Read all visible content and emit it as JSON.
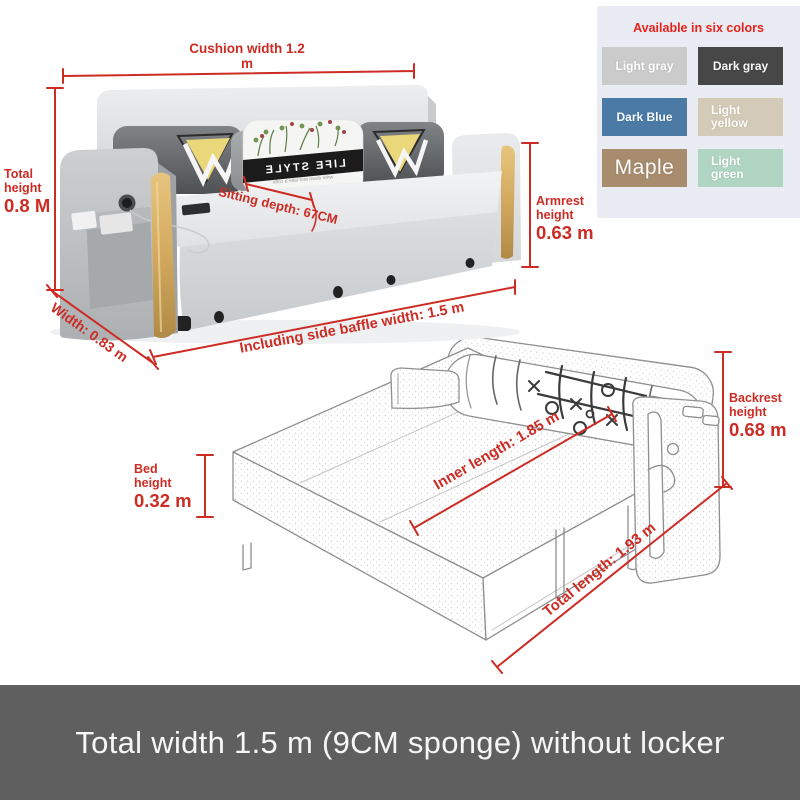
{
  "theme": {
    "accent_red": "#cd2c24",
    "panel_bg": "#e9edf3",
    "footer_bg": "#5f5f5f",
    "wood": "#c9a05c"
  },
  "colors_panel": {
    "title": "Available in six colors",
    "swatches": [
      {
        "label": "Light gray",
        "hex": "#cbcbcb"
      },
      {
        "label": "Dark gray",
        "hex": "#474747"
      },
      {
        "label": "Dark Blue",
        "hex": "#4b7aa7"
      },
      {
        "label": "Light yellow",
        "hex": "#d3cbb7"
      },
      {
        "label": "Maple",
        "hex": "#a78c6d"
      },
      {
        "label": "Light green",
        "hex": "#b1d5c3"
      }
    ]
  },
  "pillow": {
    "brand_text": "LIFE STYLE",
    "sub_text": "write down and take a coffe"
  },
  "dimensions": {
    "cushion_width": "Cushion width 1.2 m",
    "total_height": {
      "line1": "Total",
      "line2": "height",
      "value": "0.8 M"
    },
    "width": "Width: 0.83 m",
    "sitting_depth": "Sitting depth: 67CM",
    "armrest_height": {
      "line1": "Armrest",
      "line2": "height",
      "value": "0.63 m"
    },
    "baffle_width": "Including side baffle width: 1.5 m",
    "bed_height": {
      "line1": "Bed",
      "line2": "height",
      "value": "0.32 m"
    },
    "inner_length": "Inner length: 1.85 m",
    "backrest_height": {
      "line1": "Backrest",
      "line2": "height",
      "value": "0.68 m"
    },
    "total_length": "Total length: 1.93 m"
  },
  "footer": {
    "text": "Total width 1.5 m (9CM sponge) without locker"
  }
}
